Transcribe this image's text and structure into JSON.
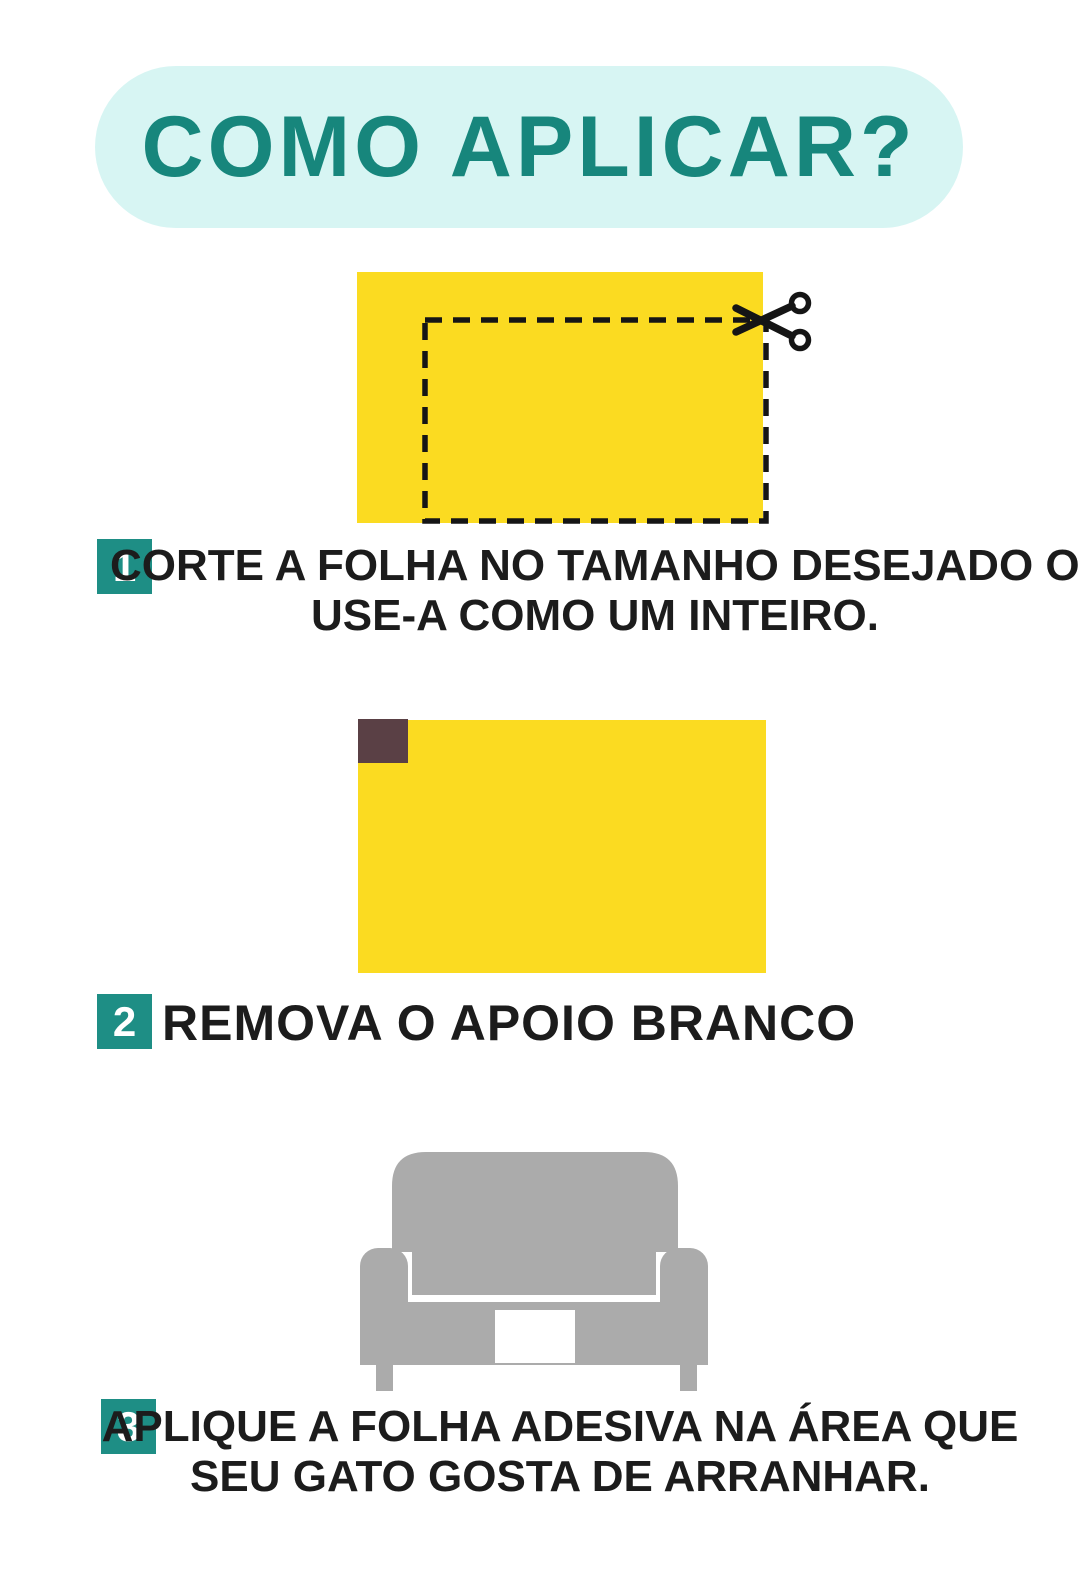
{
  "header": {
    "title": "COMO APLICAR?"
  },
  "steps": [
    {
      "number": "1",
      "lines": [
        "CORTE A FOLHA NO TAMANHO DESEJADO OU",
        "USE-A COMO UM INTEIRO."
      ],
      "illustration": "yellow adhesive sheet with dashed cut outline and scissors"
    },
    {
      "number": "2",
      "lines": [
        "REMOVA O APOIO BRANCO"
      ],
      "illustration": "yellow adhesive sheet with dark backing corner peeled"
    },
    {
      "number": "3",
      "lines": [
        "APLIQUE A FOLHA ADESIVA NA ÁREA QUE",
        "SEU GATO GOSTA DE ARRANHAR."
      ],
      "illustration": "gray couch with white adhesive sheet applied"
    }
  ],
  "icons": {
    "scissors": "scissors-icon",
    "couch": "couch-icon"
  },
  "colors": {
    "page_bg": "#FFFFFF",
    "pill_bg": "#D7F5F3",
    "title_teal": "#17867C",
    "accent_teal": "#1E8E85",
    "sheet_yellow": "#FBDB21",
    "backing_dark": "#5A4045",
    "couch_gray": "#ABABAB",
    "ink": "#151515",
    "text": "#1C1C1C",
    "white": "#FFFFFF"
  }
}
